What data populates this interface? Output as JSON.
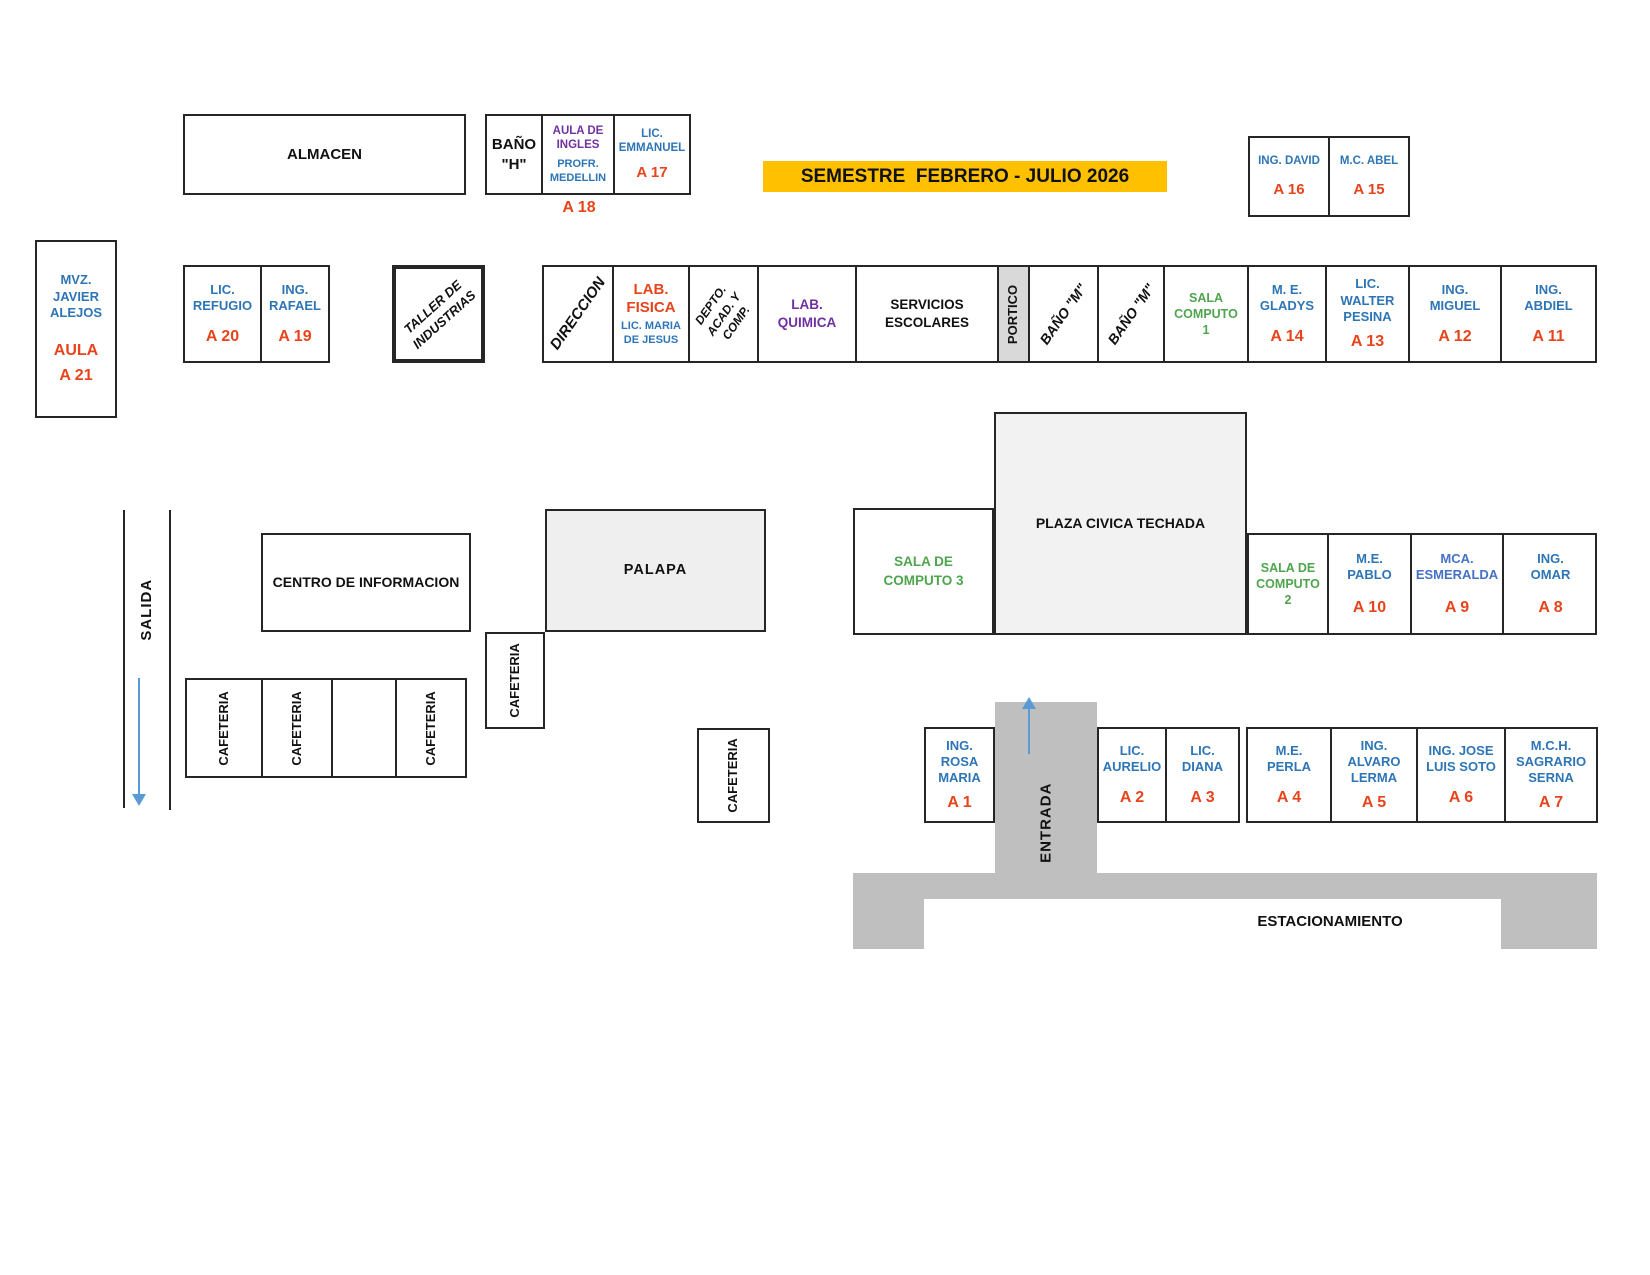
{
  "banner": {
    "title": "SEMESTRE  FEBRERO - JULIO 2026"
  },
  "colors": {
    "name_blue": "#2E75B6",
    "alt_blue": "#4472C4",
    "code_red": "#E8441C",
    "green": "#4EA54E",
    "purple": "#7030A0",
    "banner_bg": "#FFC000",
    "road_gray": "#BFBFBF",
    "portico_gray": "#D9D9D9",
    "plaza_gray": "#F2F2F2",
    "arrow_blue": "#5B9BD5",
    "border": "#262626"
  },
  "labels": {
    "almacen": "ALMACEN",
    "bano_h": "BAÑO \"H\"",
    "bano_m": "BAÑO \"M\"",
    "aula_ingles": "AULA DE INGLES",
    "profr_medellin": "PROFR. MEDELLIN",
    "taller": "TALLER DE INDUSTRIAS",
    "direccion": "DIRECCION",
    "lab_fisica": "LAB. FISICA",
    "maria_de_jesus": "LIC. MARIA DE JESUS",
    "depto": "DEPTO. ACAD. Y COMP.",
    "lab_quimica": "LAB. QUIMICA",
    "servicios": "SERVICIOS ESCOLARES",
    "portico": "PORTICO",
    "sala_computo_1": "SALA COMPUTO 1",
    "sala_computo_2": "SALA DE COMPUTO 2",
    "sala_computo_3": "SALA DE COMPUTO 3",
    "plaza": "PLAZA CIVICA TECHADA",
    "centro_informacion": "CENTRO DE INFORMACION",
    "palapa": "PALAPA",
    "cafeteria": "CAFETERIA",
    "salida": "SALIDA",
    "entrada": "ENTRADA",
    "estacionamiento": "ESTACIONAMIENTO"
  },
  "rooms": {
    "a21": {
      "name": "MVZ. JAVIER ALEJOS",
      "label": "AULA",
      "code": "A 21"
    },
    "a20": {
      "name": "LIC. REFUGIO",
      "code": "A 20"
    },
    "a19": {
      "name": "ING. RAFAEL",
      "code": "A 19"
    },
    "a18": {
      "code": "A 18"
    },
    "a17": {
      "name": "LIC. EMMANUEL",
      "code": "A 17"
    },
    "a16": {
      "name": "ING. DAVID",
      "code": "A 16"
    },
    "a15": {
      "name": "M.C. ABEL",
      "code": "A 15"
    },
    "a14": {
      "name": "M. E. GLADYS",
      "code": "A 14"
    },
    "a13": {
      "name": "LIC. WALTER PESINA",
      "code": "A 13"
    },
    "a12": {
      "name": "ING. MIGUEL",
      "code": "A 12"
    },
    "a11": {
      "name": "ING. ABDIEL",
      "code": "A 11"
    },
    "a10": {
      "name": "M.E. PABLO",
      "code": "A 10"
    },
    "a9": {
      "name": "MCA. ESMERALDA",
      "code": "A 9"
    },
    "a8": {
      "name": "ING. OMAR",
      "code": "A 8"
    },
    "a7": {
      "name": "M.C.H. SAGRARIO SERNA",
      "code": "A 7"
    },
    "a6": {
      "name": "ING. JOSE LUIS SOTO",
      "code": "A 6"
    },
    "a5": {
      "name": "ING. ALVARO LERMA",
      "code": "A 5"
    },
    "a4": {
      "name": "M.E. PERLA",
      "code": "A 4"
    },
    "a3": {
      "name": "LIC. DIANA",
      "code": "A 3"
    },
    "a2": {
      "name": "LIC. AURELIO",
      "code": "A 2"
    },
    "a1": {
      "name": "ING. ROSA MARIA",
      "code": "A 1"
    }
  }
}
